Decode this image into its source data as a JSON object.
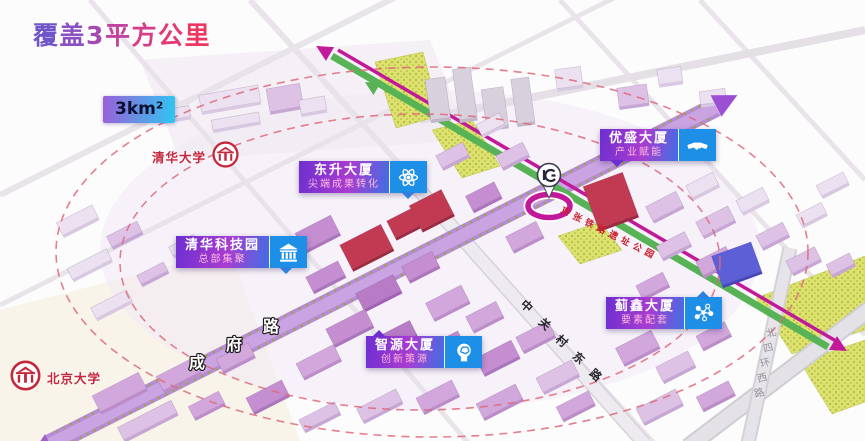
{
  "title": "覆盖3平方公里",
  "area_badge": "3km²",
  "universities": [
    {
      "name": "清华大学"
    },
    {
      "name": "北京大学"
    }
  ],
  "callouts": [
    {
      "name": "东升大厦",
      "tagline": "尖端成果转化",
      "icon": "atom-icon"
    },
    {
      "name": "优盛大厦",
      "tagline": "产业赋能",
      "icon": "handshake-icon"
    },
    {
      "name": "清华科技园",
      "tagline": "总部集聚",
      "icon": "bank-icon"
    },
    {
      "name": "智源大厦",
      "tagline": "创新策源",
      "icon": "brain-icon"
    },
    {
      "name": "蓟鑫大厦",
      "tagline": "要素配套",
      "icon": "network-icon"
    }
  ],
  "roads": [
    {
      "name": "成府路"
    },
    {
      "name": "中关村东路"
    },
    {
      "name": "北四环西路"
    }
  ],
  "park_label": "京张铁路遗址公园",
  "landmarks": [
    {
      "name": "地铁站",
      "icon": "subway-icon"
    }
  ],
  "colors": {
    "accent_magenta": "#c2189a",
    "accent_green": "#57b355",
    "callout_blue": "#1e8fe6",
    "callout_purple": "#6d2fd0",
    "university_red": "#c5283c",
    "coverage_dash": "#e0697c",
    "key_building_red": "#c23a52",
    "road_purple": "#b78cd6"
  }
}
